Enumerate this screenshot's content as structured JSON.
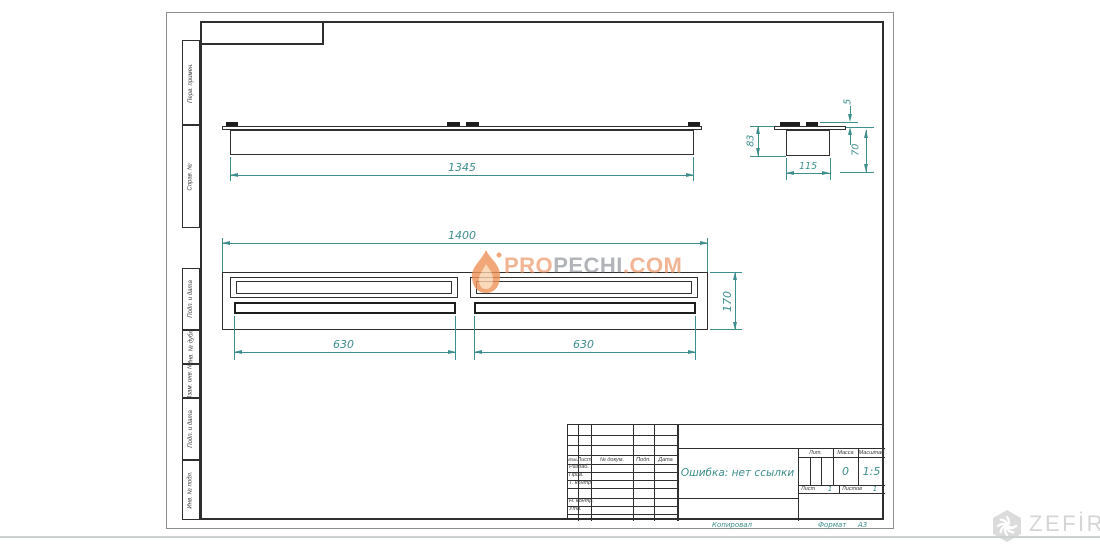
{
  "colors": {
    "drawing_line": "#2f2f2f",
    "dimension": "#3d8e8c",
    "watermark_orange": "#e8834e",
    "watermark_gray": "#535863",
    "logo_gray": "#d5d5d5"
  },
  "strip": {
    "items": [
      "Перв. примен.",
      "Справ. №",
      "Подп. и дата",
      "Инв. № дубл.",
      "Взам. инв. №",
      "Подп. и дата",
      "Инв. № подл."
    ]
  },
  "dims": {
    "front_length": "1345",
    "side_height": "83",
    "side_width": "115",
    "side_top": "5",
    "side_lower": "70",
    "plan_length": "1400",
    "plan_depth": "170",
    "slot_left": "630",
    "slot_right": "630"
  },
  "watermark": {
    "pro": "PRO",
    "mid": "PECHI",
    "tld": ".COM"
  },
  "logo": {
    "brand": "ZEFİRE"
  },
  "title_block": {
    "change_cols": [
      "Изм.",
      "Лист",
      "№ докум.",
      "Подп.",
      "Дата"
    ],
    "sign_rows": [
      "Разраб.",
      "Пров.",
      "Т. контр.",
      "Н. контр.",
      "Утв."
    ],
    "designation": "Ошибка: нет ссылки",
    "lit": "Лит.",
    "mass_label": "Масса",
    "mass": "0",
    "scale_label": "Масштаб",
    "scale": "1:5",
    "sheet_label": "Лист",
    "sheet": "1",
    "sheets_label": "Листов",
    "sheets": "1",
    "copied": "Копировал",
    "format_label": "Формат",
    "format": "А3"
  }
}
